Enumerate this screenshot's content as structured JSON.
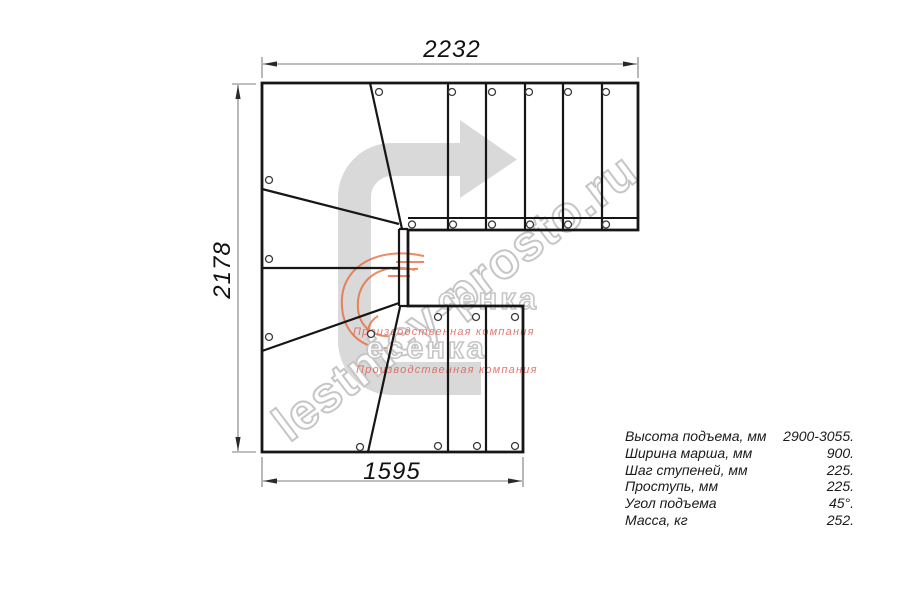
{
  "drawing": {
    "title_hint": "L-shaped staircase plan with 180-degree winder turn",
    "dimensions": {
      "top_width_mm": "2232",
      "left_height_mm": "2178",
      "bottom_width_mm": "1595"
    },
    "specs": {
      "rows": [
        {
          "label": "Высота подъема, мм",
          "value": "2900-3055."
        },
        {
          "label": "Ширина марша, мм",
          "value": "900."
        },
        {
          "label": "Шаг ступеней, мм",
          "value": "225."
        },
        {
          "label": "Проступь, мм",
          "value": "225."
        },
        {
          "label": "Угол подъема",
          "value": "45°."
        },
        {
          "label": "Масса, кг",
          "value": "252."
        }
      ]
    },
    "watermark": {
      "diagonal_text": "lestnicy-prosto.ru",
      "brand_row_a": "сенка",
      "brand_row_b": "есенка",
      "caption": "Производственная компания"
    },
    "colors": {
      "line": "#161616",
      "dimension_line": "#7d7d7d",
      "direction_arrow_fill": "#d9d9d9",
      "watermark_gray": "#c6c6c6",
      "caption_red": "#e0574d",
      "flame_orange": "#e8642f",
      "background": "#ffffff"
    }
  }
}
